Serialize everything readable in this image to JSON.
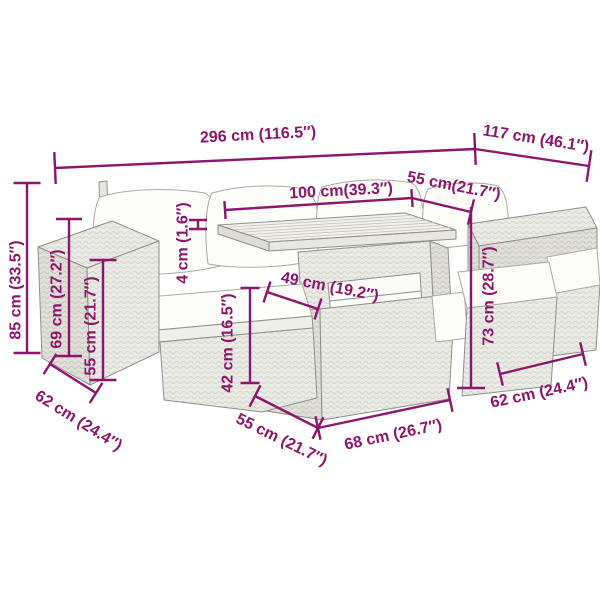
{
  "accent_color": "#8d156c",
  "background_color": "#ffffff",
  "diagram": {
    "type": "product-dimension-diagram",
    "subject": "garden-furniture-set"
  },
  "dimensions": [
    {
      "id": "dim-296",
      "label": "296 cm (116.5″)",
      "x1": 55,
      "y1": 168,
      "x2": 475,
      "y2": 149,
      "tick": 32,
      "ticks": "both",
      "lx": 258,
      "ly": 134,
      "lr": -3
    },
    {
      "id": "dim-117",
      "label": "117 cm (46.1″)",
      "x1": 475,
      "y1": 149,
      "x2": 589,
      "y2": 166,
      "tick": 32,
      "ticks": "end",
      "lx": 536,
      "ly": 138,
      "lr": 9
    },
    {
      "id": "dim-100",
      "label": "100 cm(39.3″)",
      "x1": 225,
      "y1": 210,
      "x2": 412,
      "y2": 198,
      "tick": 18,
      "ticks": "both",
      "lx": 341,
      "ly": 190,
      "lr": -3
    },
    {
      "id": "dim-55-top",
      "label": "55 cm(21.7″)",
      "x1": 412,
      "y1": 198,
      "x2": 471,
      "y2": 212,
      "tick": 26,
      "ticks": "end",
      "lx": 454,
      "ly": 185,
      "lr": 11
    },
    {
      "id": "dim-4",
      "label": "4 cm (1.6″)",
      "x1": 198,
      "y1": 220,
      "x2": 198,
      "y2": 229,
      "tick": 18,
      "ticks": "both",
      "lx": 182,
      "ly": 243,
      "lr": -90
    },
    {
      "id": "dim-85",
      "label": "85 cm (33.5″)",
      "x1": 27,
      "y1": 183,
      "x2": 27,
      "y2": 353,
      "tick": 27,
      "ticks": "both",
      "lx": 15,
      "ly": 290,
      "lr": -90
    },
    {
      "id": "dim-69",
      "label": "69 cm (27.2″)",
      "x1": 69,
      "y1": 219,
      "x2": 69,
      "y2": 356,
      "tick": 26,
      "ticks": "both",
      "lx": 56,
      "ly": 299,
      "lr": -90
    },
    {
      "id": "dim-55-left",
      "label": "55 cm (21.7″)",
      "x1": 103,
      "y1": 260,
      "x2": 103,
      "y2": 380,
      "tick": 27,
      "ticks": "both",
      "lx": 90,
      "ly": 326,
      "lr": -90
    },
    {
      "id": "dim-49",
      "label": "49 cm (19.2″)",
      "x1": 267,
      "y1": 292,
      "x2": 318,
      "y2": 309,
      "tick": 22,
      "ticks": "both",
      "lx": 330,
      "ly": 286,
      "lr": 11
    },
    {
      "id": "dim-42",
      "label": "42 cm (16.5″)",
      "x1": 250,
      "y1": 288,
      "x2": 250,
      "y2": 383,
      "tick": 19,
      "ticks": "both",
      "lx": 227,
      "ly": 343,
      "lr": -90
    },
    {
      "id": "dim-73",
      "label": "73 cm (28.7″)",
      "x1": 471,
      "y1": 207,
      "x2": 471,
      "y2": 388,
      "tick": 28,
      "ticks": "end",
      "lx": 488,
      "ly": 296,
      "lr": -90
    },
    {
      "id": "dim-62-bl",
      "label": "62 cm (24.4″)",
      "x1": 50,
      "y1": 364,
      "x2": 96,
      "y2": 393,
      "tick": 24,
      "ticks": "both",
      "lx": 79,
      "ly": 420,
      "lr": 32
    },
    {
      "id": "dim-55-bot",
      "label": "55 cm (21.7″)",
      "x1": 255,
      "y1": 396,
      "x2": 318,
      "y2": 428,
      "tick": 24,
      "ticks": "both",
      "lx": 282,
      "ly": 439,
      "lr": 26
    },
    {
      "id": "dim-68",
      "label": "68 cm (26.7″)",
      "x1": 318,
      "y1": 428,
      "x2": 450,
      "y2": 400,
      "tick": 24,
      "ticks": "both",
      "lx": 393,
      "ly": 434,
      "lr": -12
    },
    {
      "id": "dim-62-br",
      "label": "62 cm (24.4″)",
      "x1": 500,
      "y1": 374,
      "x2": 583,
      "y2": 354,
      "tick": 24,
      "ticks": "both",
      "lx": 539,
      "ly": 392,
      "lr": -12
    }
  ]
}
